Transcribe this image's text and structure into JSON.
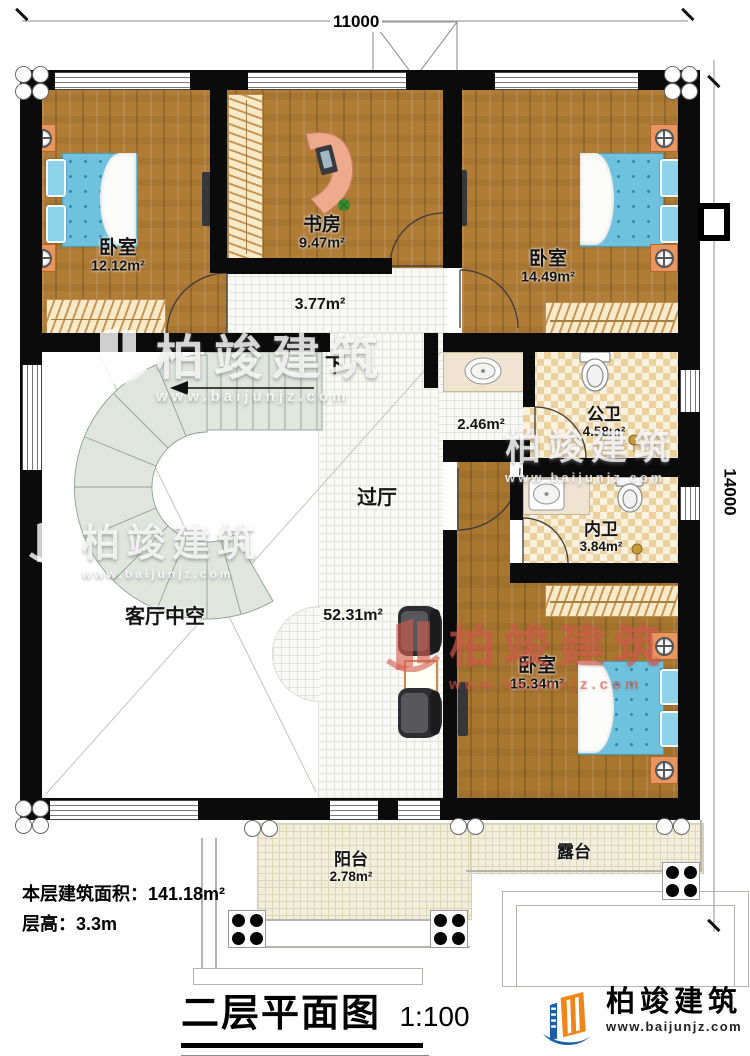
{
  "dims": {
    "top": "11000",
    "right": "14000"
  },
  "rooms": {
    "bed1": {
      "name": "卧室",
      "area": "12.12m²"
    },
    "study": {
      "name": "书房",
      "area": "9.47m²"
    },
    "bed2": {
      "name": "卧室",
      "area": "14.49m²"
    },
    "corridor": {
      "area": "3.77m²"
    },
    "vanity": {
      "area": "2.46m²"
    },
    "pub_bath": {
      "name": "公卫",
      "area": "4.58m²"
    },
    "priv_bath": {
      "name": "内卫",
      "area": "3.84m²"
    },
    "bed3": {
      "name": "卧室",
      "area": "15.34m²"
    },
    "hall": {
      "name": "过厅",
      "area": "52.31m²"
    },
    "void": {
      "name": "客厅中空"
    },
    "balcony": {
      "name": "阳台",
      "area": "2.78m²"
    },
    "terrace": {
      "name": "露台"
    },
    "down": "下"
  },
  "info": {
    "area_label": "本层建筑面积：141.18m²",
    "height_label": "层高：3.3m"
  },
  "title": {
    "text": "二层平面图",
    "scale": "1:100"
  },
  "brand": {
    "name": "柏竣建筑",
    "url": "www.baijunjz.com"
  },
  "watermark": {
    "name": "柏竣建筑",
    "url": "www.baijunjz.com"
  },
  "colors": {
    "accent_blue": "#1b5ea8",
    "accent_orange": "#f08519",
    "wood": "#b07c36"
  }
}
